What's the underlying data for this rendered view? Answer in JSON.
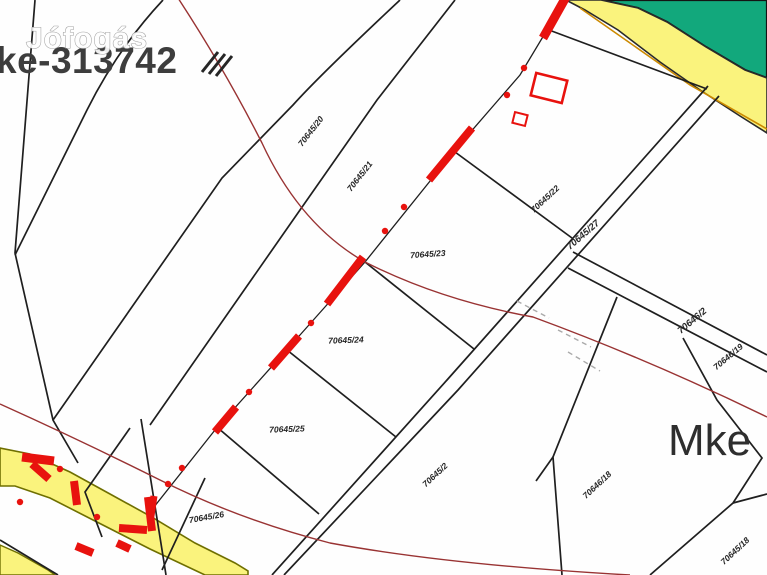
{
  "watermark": {
    "text": "Jófogás"
  },
  "header": {
    "map_id": "ke-313742"
  },
  "region": {
    "label": "Mke"
  },
  "parcels": [
    {
      "label": "70645/20"
    },
    {
      "label": "70645/21"
    },
    {
      "label": "70645/22"
    },
    {
      "label": "70645/27"
    },
    {
      "label": "70645/23"
    },
    {
      "label": "70645/24"
    },
    {
      "label": "70645/25"
    },
    {
      "label": "70645/26"
    },
    {
      "label": "70645/2"
    },
    {
      "label": "70646/18"
    },
    {
      "label": "70646/2"
    },
    {
      "label": "70646/19"
    },
    {
      "label": "70645/18"
    }
  ],
  "colors": {
    "boundary_black": "#1f1f1f",
    "highlight_red": "#e8120e",
    "contour_red": "#993333",
    "zone_green": "#12a87c",
    "zone_yellow": "#faf37d",
    "road_outline_olive": "#6f6f00",
    "survey_grey": "#aaaaaa"
  }
}
